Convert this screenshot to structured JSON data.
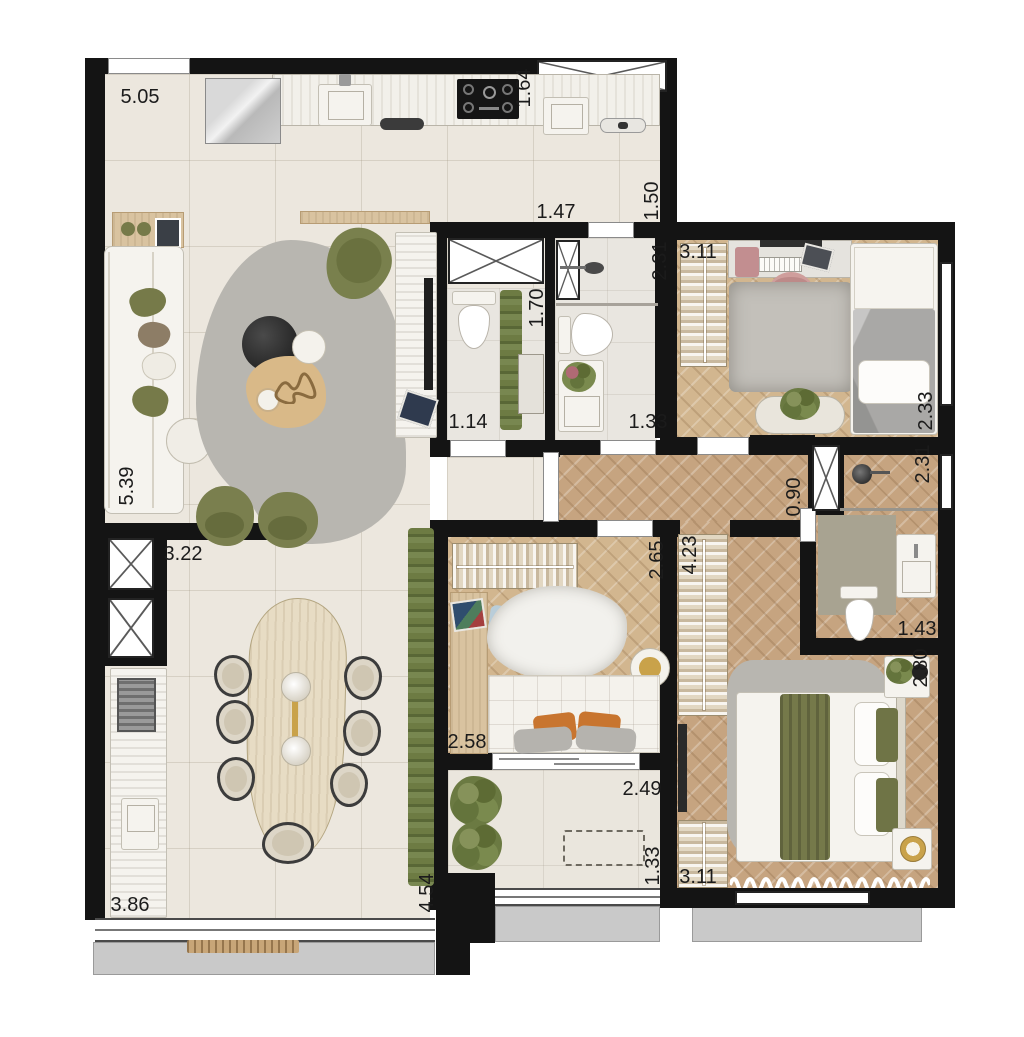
{
  "plan": {
    "type": "apartment-floor-plan",
    "style": "top-down furnished render",
    "colors": {
      "wall": "#141414",
      "tile_floor": "#ece7de",
      "wood_floor": "#c6a480",
      "bath_floor": "#e9e6e0",
      "greenery": "#767a49",
      "exterior_ledge": "#c9c9c9",
      "label_text": "#1b1b1b"
    },
    "dimensions": [
      {
        "text": "5.05",
        "area": "living-kitchen-width",
        "x": 140,
        "y": 97,
        "vertical": false
      },
      {
        "text": "1.64",
        "area": "kitchen-window",
        "x": 524,
        "y": 88,
        "vertical": true
      },
      {
        "text": "1.47",
        "area": "hall-passage",
        "x": 556,
        "y": 212,
        "vertical": false
      },
      {
        "text": "1.50",
        "area": "kitchen-passage",
        "x": 652,
        "y": 201,
        "vertical": true
      },
      {
        "text": "2.31",
        "area": "bathroom-2-shower-depth",
        "x": 660,
        "y": 261,
        "vertical": true
      },
      {
        "text": "3.11",
        "area": "bedroom-1-width",
        "x": 698,
        "y": 252,
        "vertical": false
      },
      {
        "text": "2.33",
        "area": "bedroom-1-depth",
        "x": 926,
        "y": 411,
        "vertical": true
      },
      {
        "text": "1.70",
        "area": "lavabo-depth",
        "x": 537,
        "y": 308,
        "vertical": true
      },
      {
        "text": "1.14",
        "area": "lavabo-width",
        "x": 468,
        "y": 422,
        "vertical": false
      },
      {
        "text": "1.33",
        "area": "bathroom-2-width",
        "x": 648,
        "y": 422,
        "vertical": false
      },
      {
        "text": "0.90",
        "area": "corridor-width",
        "x": 794,
        "y": 497,
        "vertical": true
      },
      {
        "text": "2.31",
        "area": "master-bath-shower-depth",
        "x": 923,
        "y": 464,
        "vertical": true
      },
      {
        "text": "5.39",
        "area": "living-depth",
        "x": 127,
        "y": 486,
        "vertical": true
      },
      {
        "text": "3.22",
        "area": "dining-width",
        "x": 183,
        "y": 554,
        "vertical": false
      },
      {
        "text": "2.65",
        "area": "bedroom-2-depth",
        "x": 657,
        "y": 560,
        "vertical": true
      },
      {
        "text": "4.23",
        "area": "master-wardrobe-length",
        "x": 690,
        "y": 555,
        "vertical": true
      },
      {
        "text": "1.43",
        "area": "master-bathroom-width",
        "x": 917,
        "y": 629,
        "vertical": false
      },
      {
        "text": "2.80",
        "area": "master-bedroom-depth",
        "x": 921,
        "y": 668,
        "vertical": true
      },
      {
        "text": "2.58",
        "area": "bedroom-2-width",
        "x": 467,
        "y": 742,
        "vertical": false
      },
      {
        "text": "2.49",
        "area": "balcony-width",
        "x": 642,
        "y": 789,
        "vertical": false
      },
      {
        "text": "1.33",
        "area": "balcony-depth",
        "x": 653,
        "y": 866,
        "vertical": true
      },
      {
        "text": "3.11",
        "area": "master-bedroom-width",
        "x": 698,
        "y": 877,
        "vertical": false
      },
      {
        "text": "3.86",
        "area": "terrace-width",
        "x": 130,
        "y": 905,
        "vertical": false
      },
      {
        "text": "4.54",
        "area": "terrace-depth",
        "x": 427,
        "y": 893,
        "vertical": true
      }
    ]
  }
}
